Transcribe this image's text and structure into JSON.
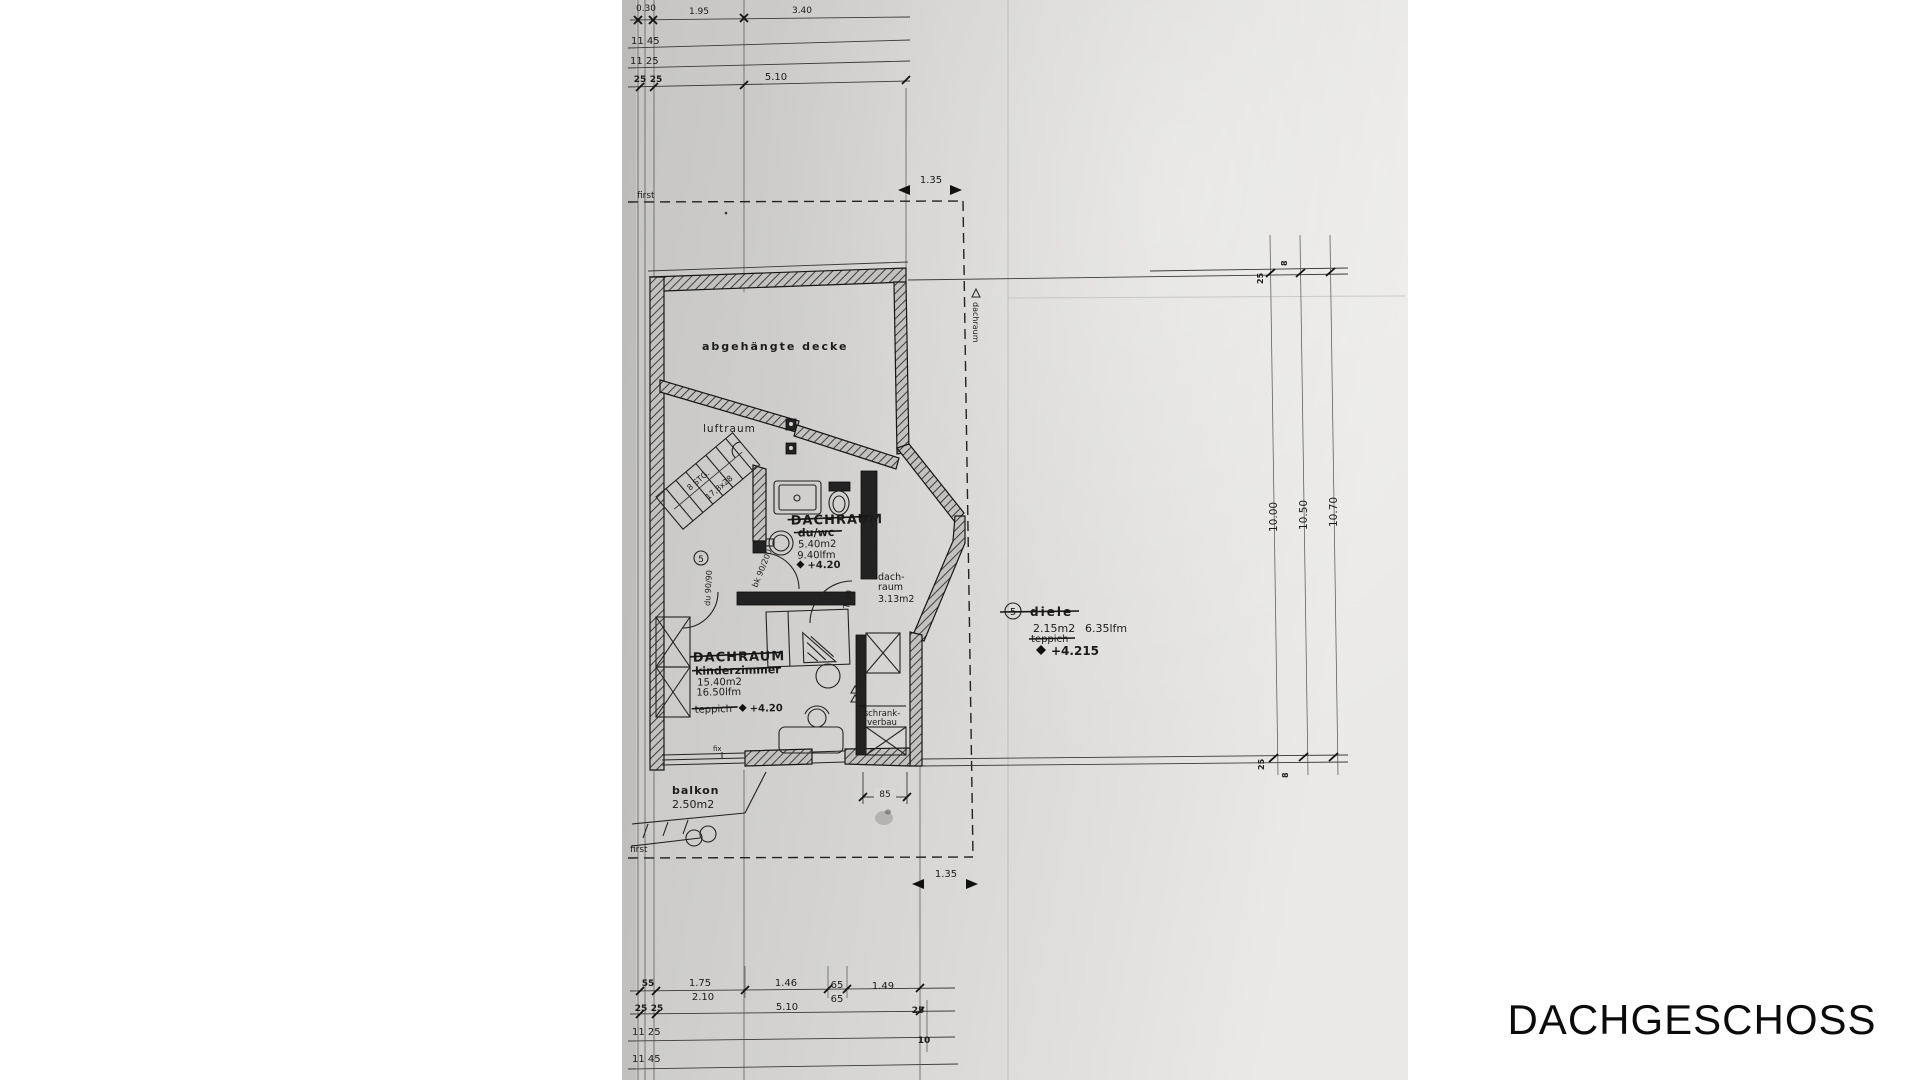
{
  "title": "DACHGESCHOSS",
  "paper": {
    "top_dims": {
      "r1a": "0.30",
      "r1b": "1.95",
      "r1c": "3.40",
      "r2": "11 45",
      "r3": "11 25",
      "r4a": "25",
      "r4b": "25",
      "r4c": "5.10"
    },
    "bottom_dims": {
      "r1a": "55",
      "r1b": "1.75",
      "r1c": "1.46",
      "r1d": "65",
      "r1e": "1.49",
      "r2a": "2.10",
      "r2b": "65",
      "r3a": "25",
      "r3b": "25",
      "r3c": "5.10",
      "r3d": "25",
      "r4a": "11 25",
      "r4b": "10",
      "r5": "11 45"
    },
    "right_dims": {
      "len1": "10.00",
      "len2": "10.50",
      "len3": "10.70",
      "tick_top_a": "25",
      "tick_top_b": "8",
      "tick_bot_a": "25",
      "tick_bot_b": "8"
    },
    "roof": {
      "first_top": "first",
      "first_bottom": "first",
      "off_top": "1.35",
      "off_bottom": "1.35",
      "edge_label": "dachraum"
    },
    "rooms": {
      "ceiling_note": "abgehängte decke",
      "void_label": "luftraum",
      "bath_name": "DACHRAUM",
      "bath_old": "du/wc",
      "bath_area": "5.40m2",
      "bath_perim": "9.40lfm",
      "bath_level": "+4.20",
      "attic_small_1": "dach-",
      "attic_small_2": "raum",
      "attic_small_area": "3.13m2",
      "child_name": "DACHRAUM",
      "child_old": "kinderzimmer",
      "child_area": "15.40m2",
      "child_perim": "16.50lfm",
      "child_floor": "teppich",
      "child_level": "+4.20",
      "hall_no": "5",
      "hall_name": "diele",
      "hall_area": "2.15m2",
      "hall_perim": "6.35lfm",
      "hall_floor": "teppich",
      "hall_level": "+4.215",
      "closet_1": "schrank-",
      "closet_2": "verbau",
      "balcony_name": "balkon",
      "balcony_area": "2.50m2",
      "door_no": "5"
    },
    "notes": {
      "stairs_1": "8 STG.",
      "stairs_2": "17,8x28",
      "door_t30": "T 30",
      "bk": "bk 90/200",
      "du": "du 90/90",
      "fix": "fix",
      "dim85": "85"
    }
  }
}
